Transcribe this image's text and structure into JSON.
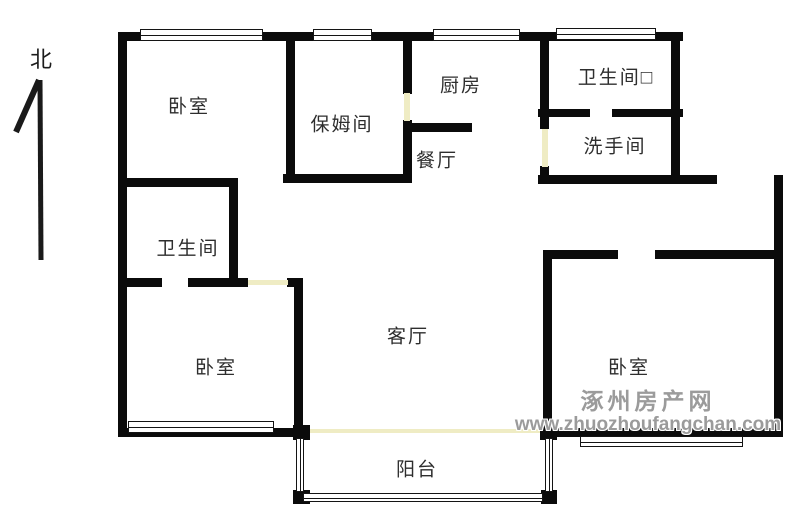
{
  "floorplan": {
    "canvas": {
      "width": 800,
      "height": 524
    },
    "colors": {
      "wall": "#0b0b0b",
      "door_opening": "#efecc4",
      "label": "#2e2e2e",
      "watermark": "#9b9b9b"
    },
    "compass": {
      "label": "北"
    },
    "watermark": {
      "line1": "涿州房产网",
      "line2": "www.zhuozhoufangchan.com"
    },
    "labels": [
      {
        "name": "bedroom-nw-label",
        "text": "卧室",
        "x": 189,
        "y": 105
      },
      {
        "name": "nanny-room-label",
        "text": "保姆间",
        "x": 342,
        "y": 123
      },
      {
        "name": "kitchen-label",
        "text": "厨房",
        "x": 461,
        "y": 84
      },
      {
        "name": "bathroom-ne-label",
        "text": "卫生间□",
        "x": 616,
        "y": 76
      },
      {
        "name": "washroom-label",
        "text": "洗手间",
        "x": 615,
        "y": 145
      },
      {
        "name": "dining-room-label",
        "text": "餐厅",
        "x": 437,
        "y": 159
      },
      {
        "name": "bathroom-w-label",
        "text": "卫生间",
        "x": 188,
        "y": 247
      },
      {
        "name": "bedroom-sw-label",
        "text": "卧室",
        "x": 216,
        "y": 366
      },
      {
        "name": "living-room-label",
        "text": "客厅",
        "x": 408,
        "y": 335
      },
      {
        "name": "bedroom-se-label",
        "text": "卧室",
        "x": 629,
        "y": 366
      },
      {
        "name": "balcony-label",
        "text": "阳台",
        "x": 417,
        "y": 468
      }
    ],
    "walls": [
      {
        "name": "outer-top-wall",
        "x": 120,
        "y": 32,
        "w": 563,
        "h": 9
      },
      {
        "name": "outer-left-wall",
        "x": 118,
        "y": 32,
        "w": 9,
        "h": 405
      },
      {
        "name": "bedroom-nw-right-wall",
        "x": 286,
        "y": 32,
        "w": 9,
        "h": 151
      },
      {
        "name": "nanny-kitchen-wall-upper",
        "x": 403,
        "y": 32,
        "w": 9,
        "h": 62
      },
      {
        "name": "nanny-kitchen-wall-lower",
        "x": 403,
        "y": 120,
        "w": 9,
        "h": 63
      },
      {
        "name": "kitchen-wash-wall-upper",
        "x": 540,
        "y": 32,
        "w": 9,
        "h": 97
      },
      {
        "name": "kitchen-wash-wall-lower",
        "x": 540,
        "y": 166,
        "w": 9,
        "h": 18
      },
      {
        "name": "bathroom-ne-right-wall",
        "x": 671,
        "y": 32,
        "w": 9,
        "h": 147
      },
      {
        "name": "bath-wash-divider-left",
        "x": 538,
        "y": 109,
        "w": 52,
        "h": 8
      },
      {
        "name": "bath-wash-divider-right",
        "x": 612,
        "y": 109,
        "w": 71,
        "h": 8
      },
      {
        "name": "kitchen-dining-divider",
        "x": 403,
        "y": 123,
        "w": 69,
        "h": 9
      },
      {
        "name": "washroom-bottom-wall",
        "x": 538,
        "y": 175,
        "w": 179,
        "h": 9
      },
      {
        "name": "bedroom-nw-bottom-wall",
        "x": 120,
        "y": 178,
        "w": 118,
        "h": 9
      },
      {
        "name": "nanny-bottom-wall",
        "x": 283,
        "y": 174,
        "w": 129,
        "h": 9
      },
      {
        "name": "bathroom-w-right-wall",
        "x": 229,
        "y": 183,
        "w": 9,
        "h": 104
      },
      {
        "name": "bathroom-w-bottom-left",
        "x": 120,
        "y": 278,
        "w": 42,
        "h": 9
      },
      {
        "name": "bathroom-w-bottom-right",
        "x": 188,
        "y": 278,
        "w": 60,
        "h": 9
      },
      {
        "name": "bedroom-sw-top-corner",
        "x": 287,
        "y": 278,
        "w": 16,
        "h": 9
      },
      {
        "name": "living-room-left-wall",
        "x": 294,
        "y": 278,
        "w": 9,
        "h": 159
      },
      {
        "name": "bedroom-se-top-wall-left",
        "x": 543,
        "y": 250,
        "w": 75,
        "h": 9
      },
      {
        "name": "bedroom-se-top-wall-right",
        "x": 655,
        "y": 250,
        "w": 126,
        "h": 9
      },
      {
        "name": "bedroom-se-left-wall",
        "x": 543,
        "y": 250,
        "w": 9,
        "h": 187
      },
      {
        "name": "outer-right-wall",
        "x": 774,
        "y": 175,
        "w": 9,
        "h": 262
      },
      {
        "name": "bedroom-sw-bottom-wall",
        "x": 120,
        "y": 428,
        "w": 190,
        "h": 9
      },
      {
        "name": "bedroom-se-bottom-wall",
        "x": 543,
        "y": 428,
        "w": 238,
        "h": 9
      },
      {
        "name": "balcony-post-top-left",
        "x": 293,
        "y": 425,
        "w": 17,
        "h": 15
      },
      {
        "name": "balcony-post-top-right",
        "x": 540,
        "y": 425,
        "w": 17,
        "h": 15
      },
      {
        "name": "balcony-post-bottom-left",
        "x": 293,
        "y": 490,
        "w": 17,
        "h": 14
      },
      {
        "name": "balcony-post-bottom-right",
        "x": 541,
        "y": 490,
        "w": 16,
        "h": 14
      }
    ],
    "windows": [
      {
        "name": "bedroom-nw-window",
        "x": 140,
        "y": 29,
        "w": 123,
        "h": 12,
        "orient": "h"
      },
      {
        "name": "nanny-room-window",
        "x": 313,
        "y": 29,
        "w": 59,
        "h": 12,
        "orient": "h"
      },
      {
        "name": "kitchen-window",
        "x": 433,
        "y": 29,
        "w": 87,
        "h": 12,
        "orient": "h"
      },
      {
        "name": "bathroom-ne-window",
        "x": 556,
        "y": 28,
        "w": 100,
        "h": 12,
        "orient": "h"
      },
      {
        "name": "bedroom-sw-window",
        "x": 128,
        "y": 421,
        "w": 146,
        "h": 12,
        "orient": "h"
      },
      {
        "name": "bedroom-se-window",
        "x": 580,
        "y": 436,
        "w": 163,
        "h": 11,
        "orient": "h"
      },
      {
        "name": "balcony-window-left",
        "x": 296,
        "y": 438,
        "w": 8,
        "h": 54,
        "orient": "v"
      },
      {
        "name": "balcony-window-front",
        "x": 303,
        "y": 493,
        "w": 240,
        "h": 9,
        "orient": "h"
      },
      {
        "name": "balcony-window-right",
        "x": 545,
        "y": 438,
        "w": 8,
        "h": 54,
        "orient": "v"
      }
    ],
    "doors": [
      {
        "name": "nanny-kitchen-door",
        "x": 404,
        "y": 93,
        "w": 6,
        "h": 28
      },
      {
        "name": "washroom-door",
        "x": 542,
        "y": 129,
        "w": 6,
        "h": 38
      },
      {
        "name": "bedroom-sw-door",
        "x": 248,
        "y": 280,
        "w": 40,
        "h": 5
      },
      {
        "name": "balcony-sliding-door",
        "x": 310,
        "y": 429,
        "w": 230,
        "h": 4
      }
    ]
  }
}
